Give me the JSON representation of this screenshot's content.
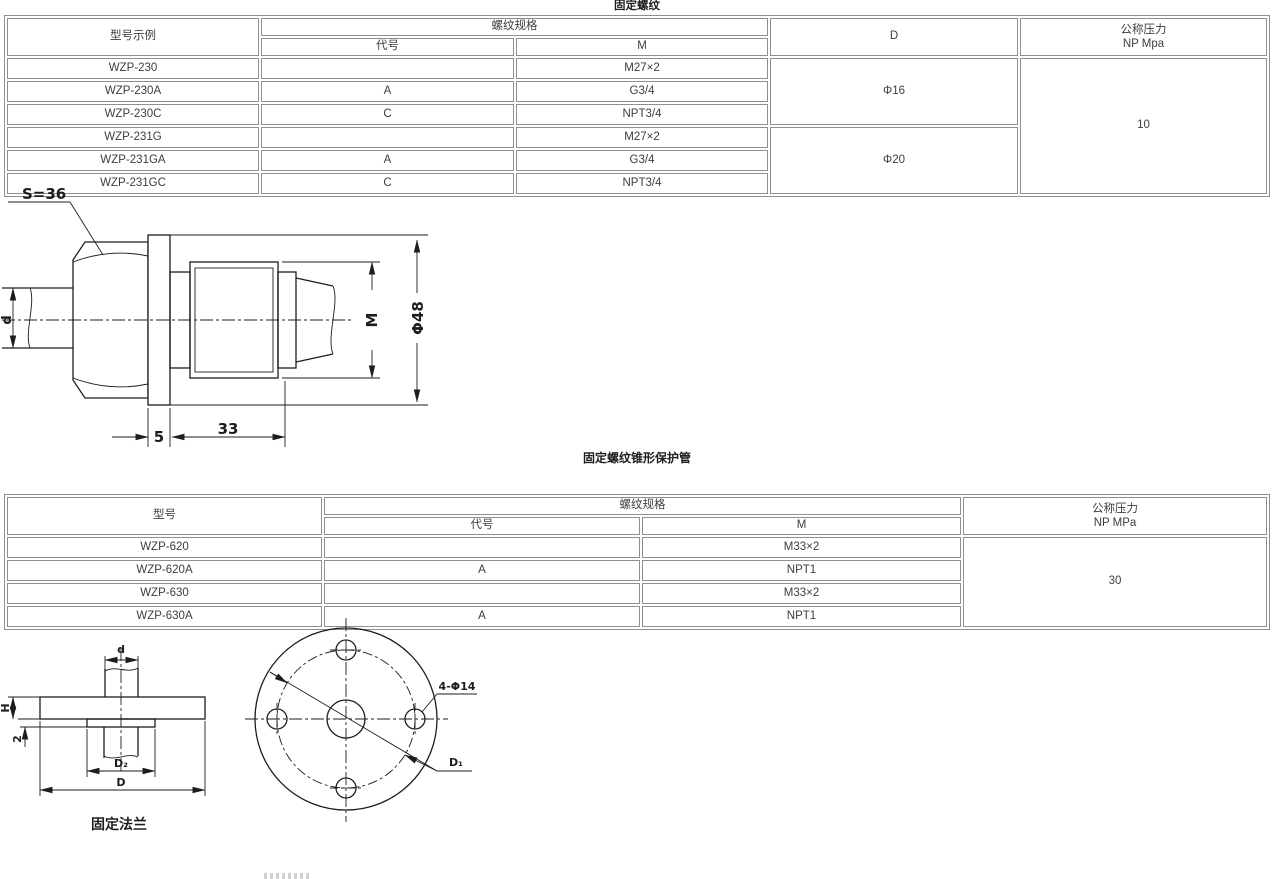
{
  "section1": {
    "title": "固定螺纹",
    "table": {
      "col_model": "型号示例",
      "col_thread": "螺纹规格",
      "col_code": "代号",
      "col_m": "M",
      "col_d": "D",
      "col_pressure_1": "公称压力",
      "col_pressure_2": "NP Mpa",
      "rows": [
        {
          "model": "WZP-230",
          "code": "",
          "m": "M27×2"
        },
        {
          "model": "WZP-230A",
          "code": "A",
          "m": "G3/4"
        },
        {
          "model": "WZP-230C",
          "code": "C",
          "m": "NPT3/4"
        },
        {
          "model": "WZP-231G",
          "code": "",
          "m": "M27×2"
        },
        {
          "model": "WZP-231GA",
          "code": "A",
          "m": "G3/4"
        },
        {
          "model": "WZP-231GC",
          "code": "C",
          "m": "NPT3/4"
        }
      ],
      "d_group1": "Φ16",
      "d_group2": "Φ20",
      "pressure": "10"
    }
  },
  "drawing1": {
    "labels": {
      "s": "S=36",
      "d": "d",
      "m": "M",
      "dia": "Φ48",
      "five": "5",
      "thirtythree": "33"
    }
  },
  "section2": {
    "title": "固定螺纹锥形保护管",
    "table": {
      "col_model": "型号",
      "col_thread": "螺纹规格",
      "col_code": "代号",
      "col_m": "M",
      "col_pressure_1": "公称压力",
      "col_pressure_2": "NP MPa",
      "rows": [
        {
          "model": "WZP-620",
          "code": "",
          "m": "M33×2"
        },
        {
          "model": "WZP-620A",
          "code": "A",
          "m": "NPT1"
        },
        {
          "model": "WZP-630",
          "code": "",
          "m": "M33×2"
        },
        {
          "model": "WZP-630A",
          "code": "A",
          "m": "NPT1"
        }
      ],
      "pressure": "30"
    }
  },
  "drawing2": {
    "labels": {
      "d": "d",
      "h": "H",
      "two": "2",
      "d2": "D₂",
      "d_outer": "D",
      "caption": "固定法兰"
    }
  },
  "drawing3": {
    "labels": {
      "holes": "4-Φ14",
      "d1": "D₁"
    }
  }
}
